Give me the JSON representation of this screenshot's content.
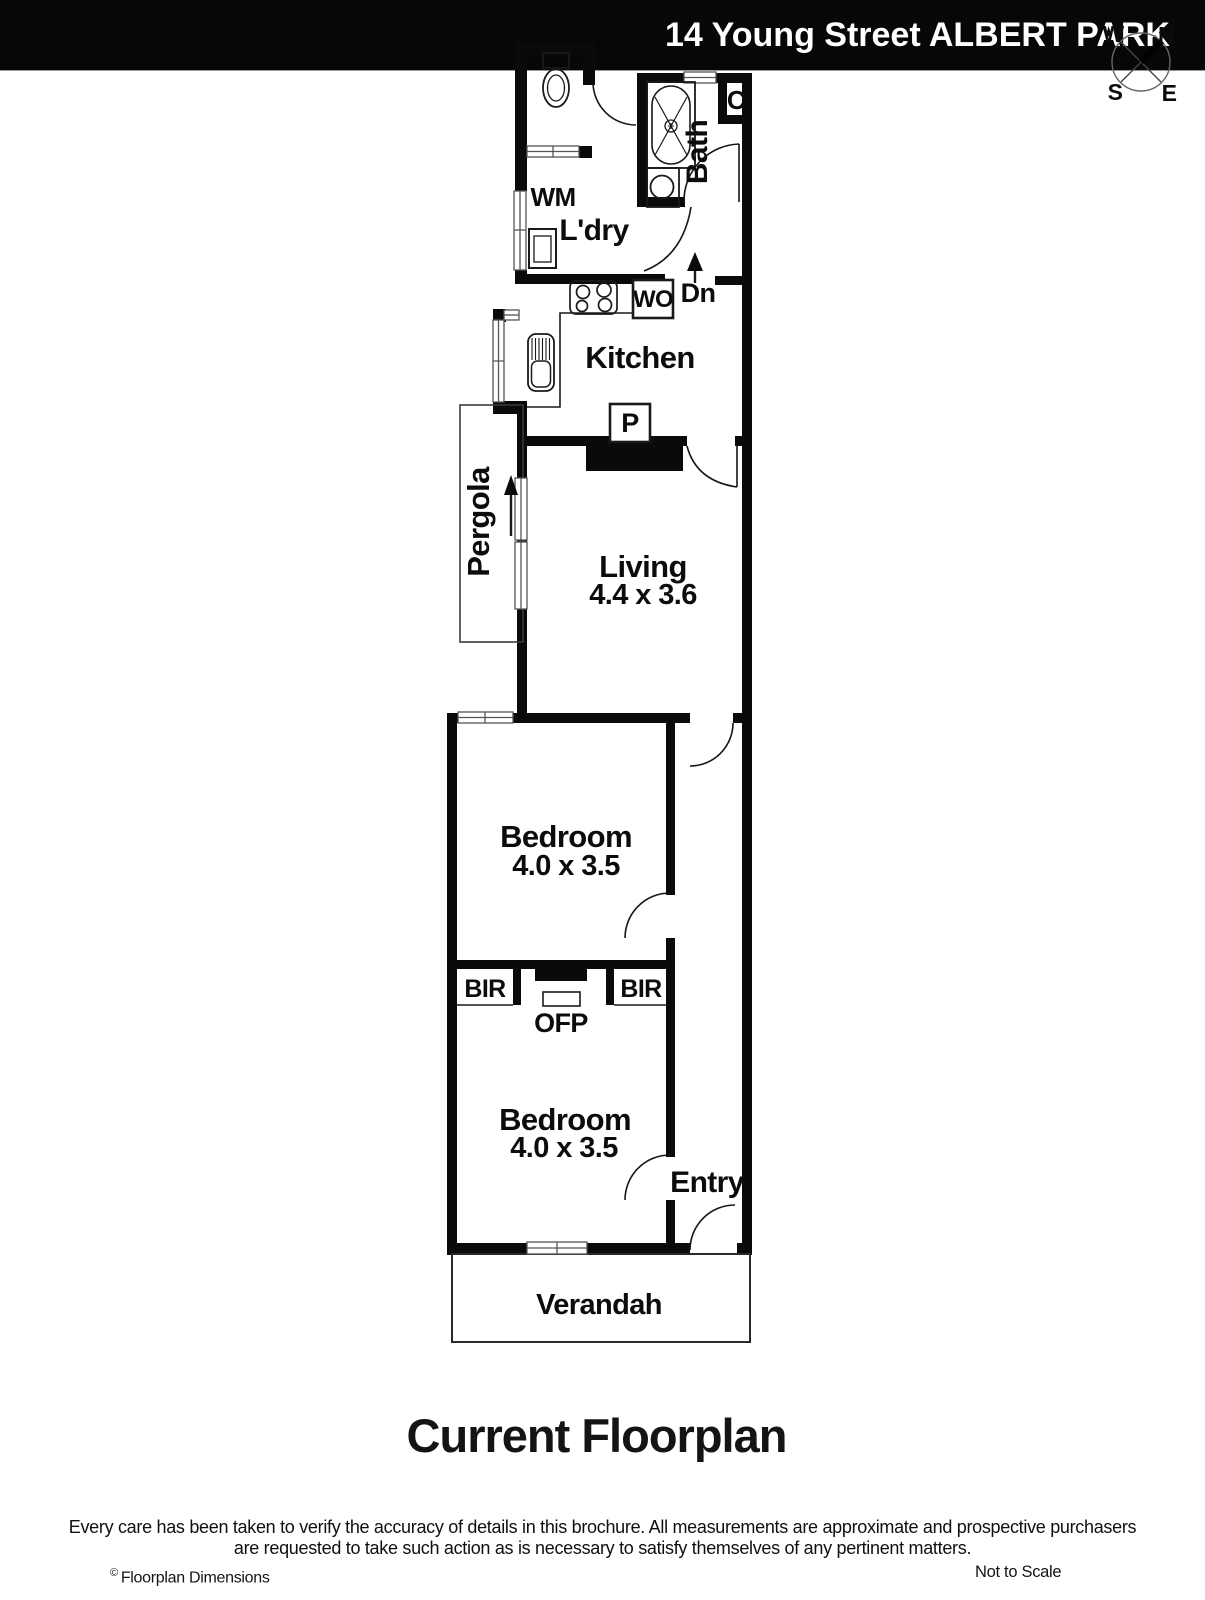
{
  "header": {
    "title": "14 Young Street ALBERT PARK"
  },
  "compass": {
    "north": "N",
    "south": "S",
    "east": "E",
    "west": "W"
  },
  "plan": {
    "wm": "WM",
    "laundry": "L'dry",
    "bath": "Bath",
    "closet": "C",
    "wall_oven": "WO",
    "down": "Dn",
    "kitchen": "Kitchen",
    "pantry": "P",
    "pergola": "Pergola",
    "living": "Living",
    "living_dim": "4.4 x 3.6",
    "bedroom_mid": "Bedroom",
    "bedroom_mid_dim": "4.0 x 3.5",
    "bir_left": "BIR",
    "bir_right": "BIR",
    "ofp": "OFP",
    "bedroom_front": "Bedroom",
    "bedroom_front_dim": "4.0 x 3.5",
    "entry": "Entry",
    "verandah": "Verandah"
  },
  "title": "Current Floorplan",
  "footer": {
    "disclaimer_line1": "Every care has been taken to verify the accuracy of details in this brochure. All measurements are approximate and prospective purchasers",
    "disclaimer_line2": "are requested to take such action as is necessary to satisfy themselves of any pertinent matters.",
    "copyright_mark": "©",
    "copyright_name": "Floorplan Dimensions",
    "scale_note": "Not to Scale"
  },
  "colors": {
    "wall": "#0a0a0a",
    "header_bg": "#070707",
    "header_text": "#ffffff"
  }
}
